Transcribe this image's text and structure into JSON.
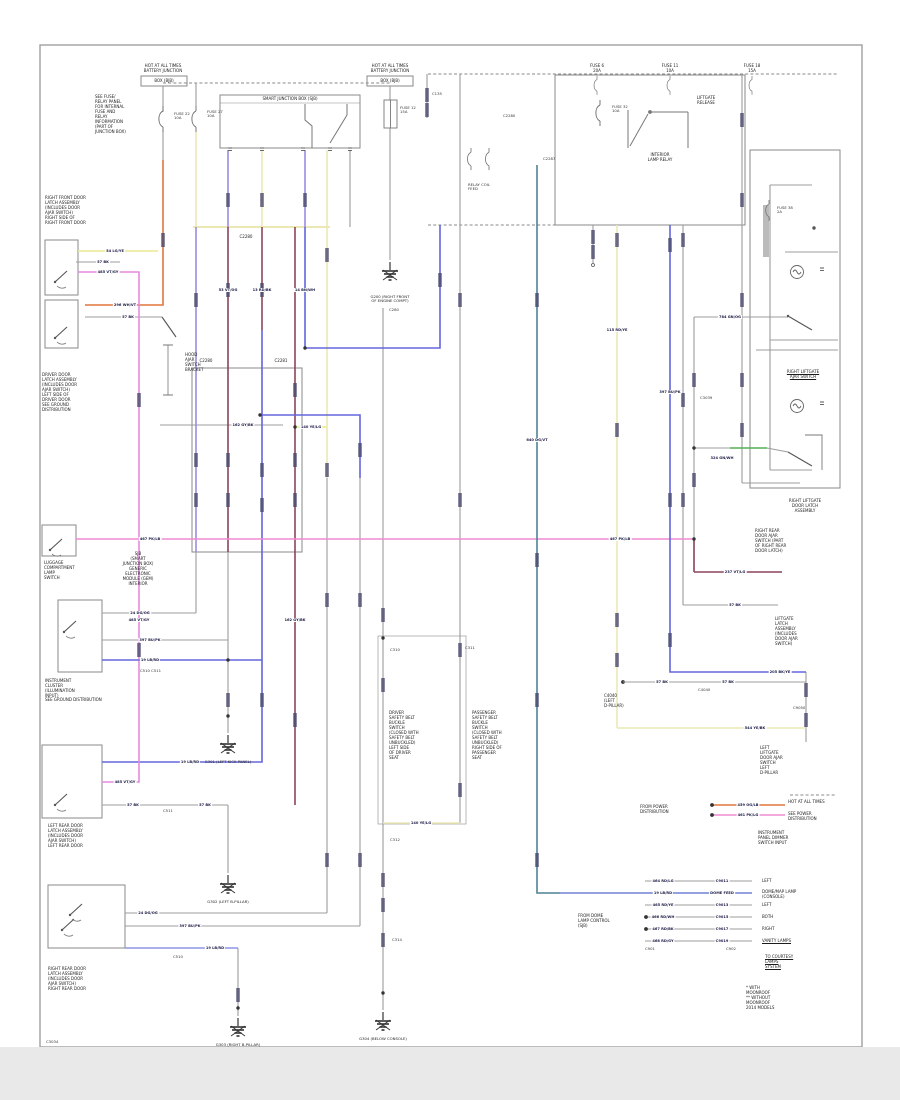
{
  "page": {
    "kind": "automotive wiring diagram",
    "colors": {
      "wire_gray": "#9c9c9c",
      "box_line": "#8a8a8a",
      "orange": "#e0763c",
      "cream": "#ece8b4",
      "yellow": "#ece98f",
      "violet": "#9b8ce0",
      "pink": "#f08ad2",
      "magenta": "#e78ade",
      "maroon": "#8a4458",
      "blue": "#6366dd",
      "light_blue": "#8e96e8",
      "teal": "#4e8494",
      "green": "#54b154",
      "seg": "#4a4a6e"
    }
  },
  "blocks": {
    "hotA": "HOT AT ALL TIMES\nBATTERY JUNCTION",
    "hotA_bar": "BOX (BJB)",
    "hotB": "HOT AT ALL TIMES\nBATTERY JUNCTION",
    "hotB_bar": "BOX (BJB)",
    "sjb_header": "SMART JUNCTION BOX (SJB)",
    "note_top_left": "SEE FUSE/\nRELAY PANEL\nFOR INTERNAL\nFUSE AND\nRELAY\nINFORMATION\n(PART OF\nJUNCTION BOX)",
    "fuse163": "FUSE 22\n10A",
    "fuse196": "FUSE 27\n10A",
    "fuse390": "FUSE 12\n15A",
    "fuseA": "FUSE 6\n20A",
    "fuseB": "FUSE 11\n10A",
    "fuseC": "FUSE 18\n15A",
    "fuse600": "FUSE 32\n10A",
    "fuse770": "FUSE 38\n2A",
    "relay_note": "INTERIOR\nLAMP RELAY",
    "bcm_note": "LIFTGATE\nRELEASE",
    "cluster_note": "RELAY COIL\nFEED",
    "c2280_bus": "C2280",
    "c2280a": "C2280",
    "c2281": "C2281",
    "c2280c": "C2280",
    "c427": "C135",
    "c383top": "C280",
    "rf_door": "RIGHT FRONT DOOR\nLATCH ASSEMBLY\n(INCLUDES DOOR\nAJAR SWITCH)\nRIGHT SIDE OF\nRIGHT FRONT DOOR",
    "drv_door": "DRIVER DOOR\nLATCH ASSEMBLY\n(INCLUDES DOOR\nAJAR SWITCH)\nLEFT SIDE OF\nDRIVER DOOR\nSEE GROUND\nDISTRIBUTION",
    "hood": "HOOD\nAJAR\nSWITCH\nBRACKET",
    "lugg": "LUGGAGE\nCOMPARTMENT\nLAMP\nSWITCH",
    "sjb2": "SJB\n(SMART\nJUNCTION BOX)\nGENERIC\nELECTRONIC\nMODULE (GEM)\nINTERIOR",
    "instr": "INSTRUMENT\nCLUSTER\n(ILLUMINATION\nINPUT)",
    "instr_extra": "SEE GROUND DISTRIBUTION",
    "c510c511": "C510   C511",
    "lr_door": "LEFT REAR DOOR\nLATCH ASSEMBLY\n(INCLUDES DOOR\nAJAR SWITCH)\nLEFT REAR DOOR",
    "rr_door": "RIGHT REAR DOOR\nLATCH ASSEMBLY\n(INCLUDES DOOR\nAJAR SWITCH)\nRIGHT REAR DOOR",
    "c511b": "C511",
    "c510b": "C510",
    "c3034": "C3034",
    "beltL": "DRIVER\nSAFETY BELT\nBUCKLE\nSWITCH\n(CLOSED WITH\nSAFETY BELT\nUNBUCKLED)\nLEFT SIDE\nOF DRIVER\nSEAT",
    "beltR": "PASSENGER\nSAFETY BELT\nBUCKLE\nSWITCH\n(CLOSED WITH\nSAFETY BELT\nUNBUCKLED)\nRIGHT SIDE OF\nPASSENGER\nSEAT",
    "c310": "C310",
    "c312": "C312",
    "c314": "C314",
    "c311": "C311",
    "rlg_switch": "RIGHT LIFTGATE\nAJAR SWITCH",
    "rbox_bottom": "RIGHT LIFTGATE\nDOOR LATCH\nASSEMBLY",
    "rr_ajar": "RIGHT REAR\nDOOR AJAR\nSWITCH (PART\nOF RIGHT REAR\nDOOR LATCH)",
    "lg_latch": "LIFTGATE\nLATCH\nASSEMBLY\n(INCLUDES\nDOOR AJAR\nSWITCH)",
    "llg_switch": "LEFT\nLIFTGATE\nDOOR AJAR\nSWITCH\nLEFT\nD-PILLAR",
    "c694": "C3039",
    "conn_note": "C4040\n(LEFT\nD-PILLAR)",
    "c4040": "C4040",
    "c9050": "C9050",
    "frompwr": "FROM POWER\nDISTRIBUTION",
    "hot_small": "HOT AT ALL TIMES",
    "batt_small": "SEE POWER\nDISTRIBUTION",
    "fused_note": "INSTRUMENT\nPANEL DIMMER\nSWITCH INPUT",
    "legend_r1": "LEFT",
    "legend_r2": "DOME/MAP LAMP\n(CONSOLE)",
    "legend_r3": "LEFT",
    "legend_r4": "BOTH",
    "legend_r5": "RIGHT",
    "legend_r6": "VANITY LAMPS",
    "legend_left": "FROM DOME\nLAMP CONTROL\n(SJB)",
    "legend_c1": "C901",
    "legend_c2": "C902",
    "to_courtesy": "TO COURTESY\nLAMPS\nSYSTEM",
    "corner_note": "* WITH\nMOONROOF\n** WITHOUT\nMOONROOF\n2014 MODELS",
    "g390": "G200 (RIGHT FRONT\nOF ENGINE COMPT)",
    "g228a": "G301 (LEFT KICK PANEL)",
    "g228b": "G302 (LEFT B-PILLAR)",
    "g238": "G303 (RIGHT B-PILLAR)",
    "g383": "G304 (BELOW CONSOLE)",
    "teal_tag": "C2287"
  },
  "tags": [
    "54 LG/YE",
    "57 BK",
    "485 VT/GY",
    "296 WH/VT",
    "57 BK",
    "53 VT/OG",
    "13 RD/BK",
    "14 BN/WH",
    "162 GY/BK",
    "140 YE/LG",
    "485 VT/GY",
    "467 PK/LB",
    "467 PK/LB",
    "24 DG/OG",
    "397 BU/PK",
    "19 LB/RD",
    "19 LB/RD",
    "485 VT/GY",
    "57 BK",
    "57 BK",
    "24 DG/OG",
    "397 BU/PK",
    "19 LB/RD",
    "115 RD/YE",
    "397 BU/PK",
    "237 VT/LG",
    "57 BK",
    "784 GN/OG",
    "324 GN/WH",
    "544 YE/BK",
    "205 BK/YE",
    "57 BK",
    "57 BK",
    "464 RD/LG",
    "C9011",
    "19 LB/RD",
    "DOME FEED",
    "465 RD/YE",
    "C9013",
    "466 RD/WH",
    "C9015",
    "467 RD/BK",
    "C9017",
    "468 RD/GY",
    "C9019",
    "459 OG/LB",
    "461 PK/LG",
    "140 YE/LG",
    "640 DG/VT",
    "162 GY/BK"
  ]
}
